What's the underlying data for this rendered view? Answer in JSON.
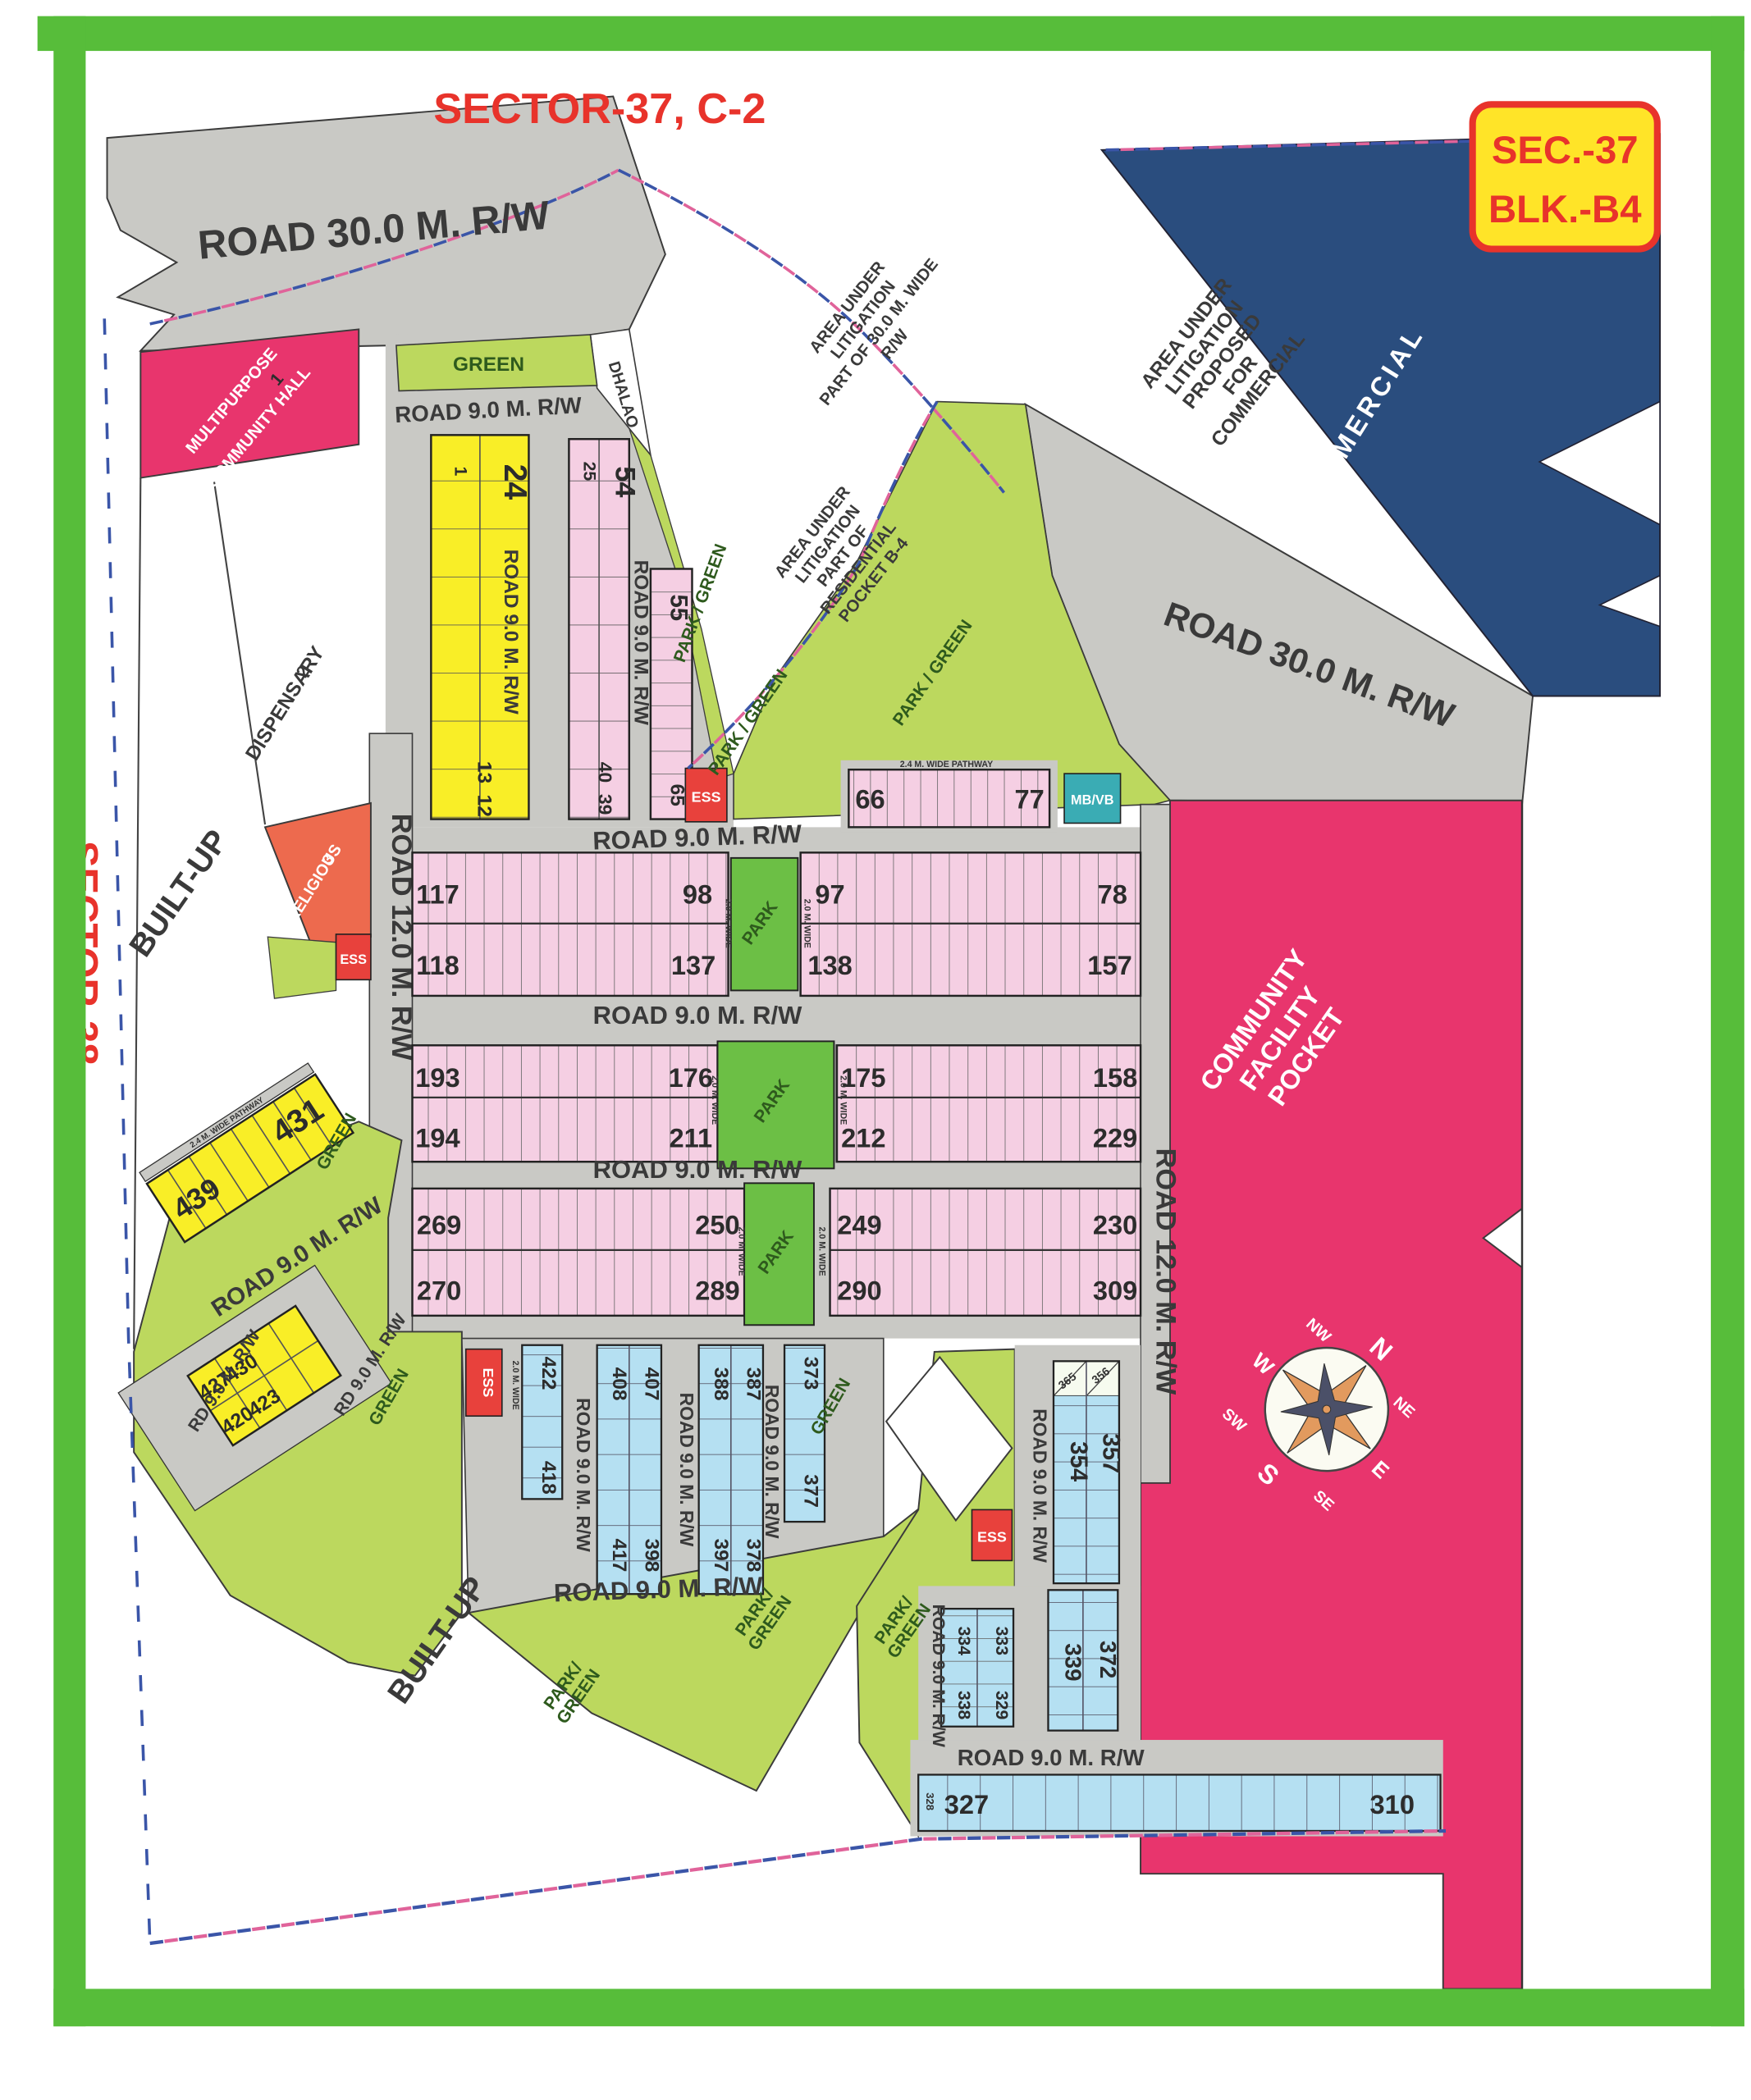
{
  "title": "SECTOR-37, C-2",
  "badge": {
    "line1": "SEC.-37",
    "line2": "BLK.-B4"
  },
  "labels": {
    "road30": "ROAD 30.0 M. R/W",
    "road9": "ROAD 9.0 M. R/W",
    "road12": "ROAD 12.0 M. R/W",
    "rd9": "RD 9.0 M. R/W",
    "sector38": "SECTOR-38",
    "built_up": "BUILT-UP",
    "green": "GREEN",
    "park": "PARK",
    "park_green": "PARK / GREEN",
    "park_green_l1": "PARK/",
    "park_green_l2": "GREEN",
    "ess": "ESS",
    "mb_vb": "MB/VB",
    "dhalao": "DHALAO",
    "commercial": "COMMERCIAL",
    "wide20": "2.0 M. WIDE",
    "pathway24": "2.4 M. WIDE PATHWAY"
  },
  "areas": {
    "community_facility": [
      "COMMUNITY",
      "FACILITY",
      "POCKET"
    ],
    "hall_no": "1",
    "hall_l1": "MULTIPURPOSE",
    "hall_l2": "COMMUNITY HALL",
    "dispensary_no": "2",
    "dispensary": "DISPENSARY",
    "religious_no": "3",
    "religious": "RELIGIOUS",
    "lit_commercial": [
      "AREA UNDER",
      "LITIGATION",
      "PROPOSED",
      "FOR",
      "COMMERCIAL"
    ],
    "lit_rw": [
      "AREA UNDER",
      "LITIGATION",
      "PART OF 30.0 M. WIDE",
      "R/W"
    ],
    "lit_residential": [
      "AREA UNDER",
      "LITIGATION",
      "PART OF",
      "RESIDENTIAL",
      "POCKET B-4"
    ]
  },
  "compass": {
    "n": "N",
    "ne": "NE",
    "e": "E",
    "se": "SE",
    "s": "S",
    "sw": "SW",
    "w": "W",
    "nw": "NW"
  },
  "plots": {
    "block_a": {
      "tl": "1",
      "tr": "24",
      "b1": "13",
      "b2": "12"
    },
    "block_b": {
      "tl": "25",
      "tr": "54",
      "b1": "40",
      "b2": "39"
    },
    "col_c": {
      "top": "55",
      "bottom": "65"
    },
    "strip_d": {
      "first": "66",
      "last": "77"
    },
    "rows": [
      {
        "lt1": "117",
        "lt2": "98",
        "lb1": "118",
        "lb2": "137",
        "rt1": "97",
        "rt2": "78",
        "rb1": "138",
        "rb2": "157"
      },
      {
        "lt1": "193",
        "lt2": "176",
        "lb1": "194",
        "lb2": "211",
        "rt1": "175",
        "rt2": "158",
        "rb1": "212",
        "rb2": "229"
      },
      {
        "lt1": "269",
        "lt2": "250",
        "lb1": "270",
        "lb2": "289",
        "rt1": "249",
        "rt2": "230",
        "rb1": "290",
        "rb2": "309"
      }
    ],
    "block_e": {
      "left": "439",
      "right": "431"
    },
    "block_f": {
      "t1": "427",
      "t2": "430",
      "b1": "420",
      "b2": "423"
    },
    "col_422": {
      "top": "422",
      "bottom": "418"
    },
    "block_g": {
      "tl": "408",
      "tr": "407",
      "bl": "417",
      "br": "398"
    },
    "block_h": {
      "tl": "388",
      "tr": "387",
      "bl": "397",
      "br": "378"
    },
    "col_i": {
      "top": "373",
      "bottom": "377"
    },
    "block_j": {
      "h1": "365",
      "h2": "356",
      "left": "354",
      "right": "357"
    },
    "block_k": {
      "left": "339",
      "right": "372"
    },
    "block_l": {
      "lt": "334",
      "lb": "338",
      "rt": "333",
      "rb": "329"
    },
    "strip_m": {
      "first": "327",
      "edge": "328",
      "last": "310"
    }
  },
  "colors": {
    "frame_green": "#57bd3a",
    "road_gray": "#c9c9c5",
    "lime": "#bcd85e",
    "park_green": "#6cbf45",
    "yellow_plot": "#f9ee27",
    "pink_plot": "#f5cfe3",
    "blue_plot": "#b5e0f2",
    "crimson": "#e8356d",
    "orange": "#ed6a4e",
    "ess_red": "#e8413c",
    "teal": "#3aacb4",
    "commercial_navy": "#2a4d7e",
    "text_red": "#e8332b",
    "badge_yellow": "#ffe428"
  }
}
